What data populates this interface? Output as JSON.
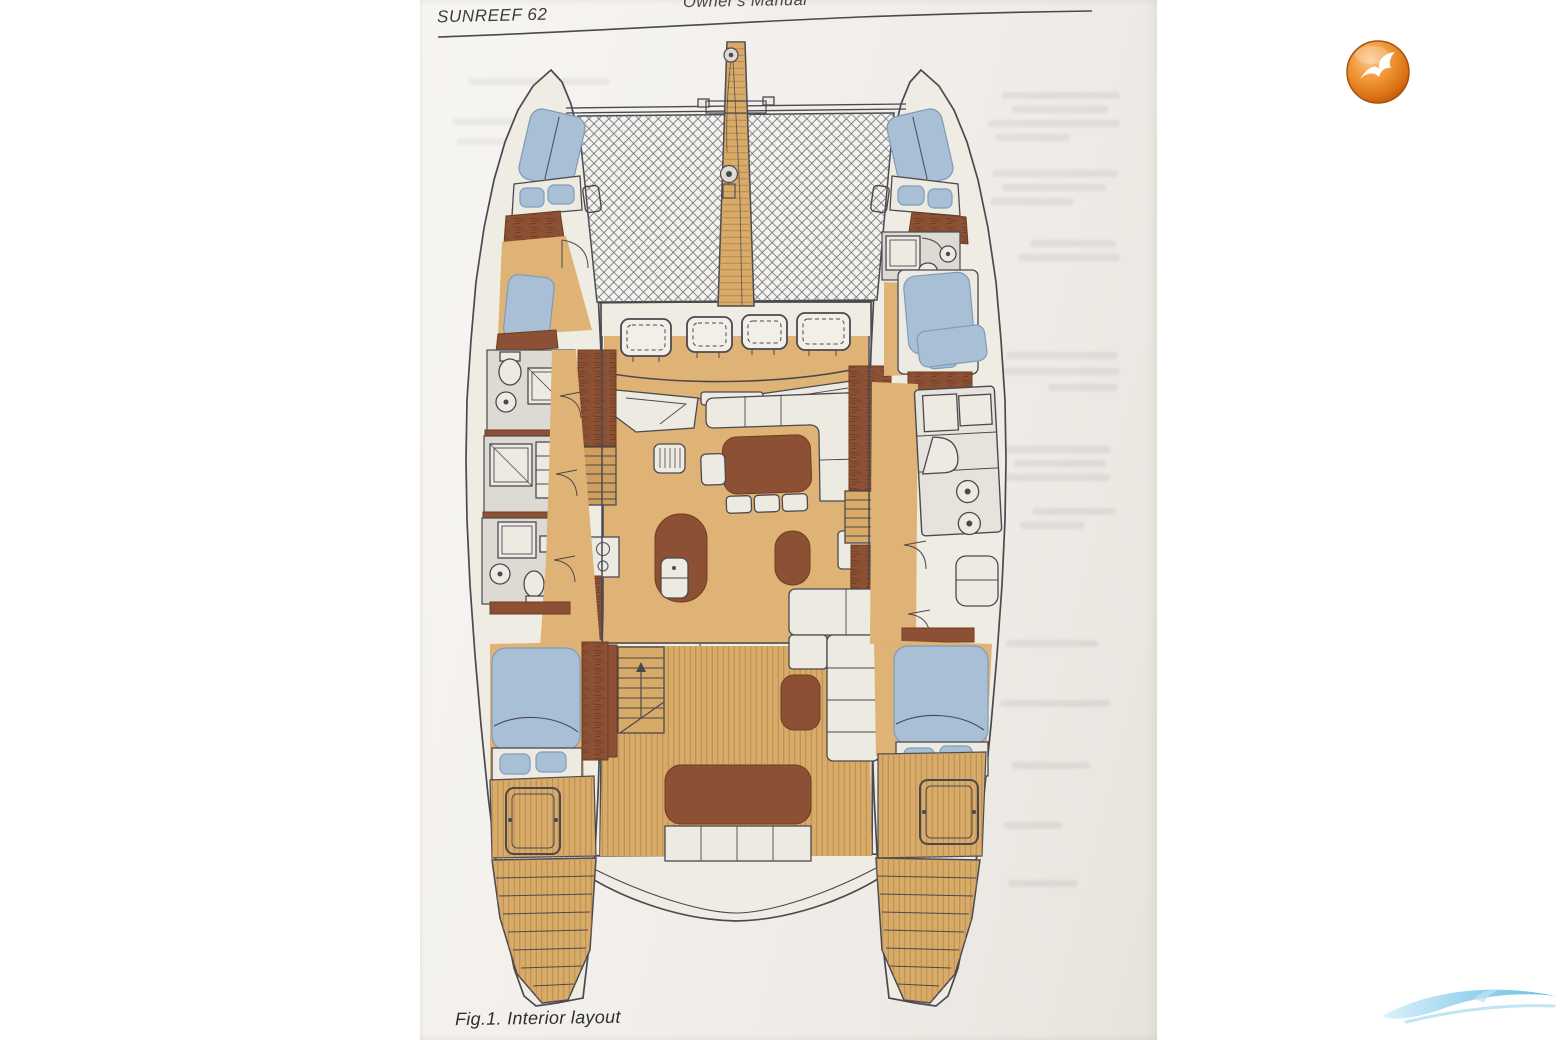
{
  "page": {
    "header_left": "SUNREEF 62",
    "header_center": "Owner's Manual",
    "figure_caption": "Fig.1. Interior layout"
  },
  "branding": {
    "corner_logo_icon": "orange-seagull-badge-icon",
    "watermark_icon": "blue-wave-swoosh-icon"
  },
  "figure": {
    "type": "catamaran-interior-floor-plan",
    "features": [
      "bowsprit-walkway",
      "anchor-windlass",
      "bow-trampoline-net",
      "v-berths",
      "bow-pillow-shelves",
      "foredeck-hatches",
      "coachroof-hatch-row",
      "helm-seats",
      "saloon-sofa",
      "saloon-dining-table-and-stools",
      "galley-island-with-sink",
      "stove-cooktop",
      "port-bathrooms",
      "starboard-forward-bathroom",
      "starboard-galley-counter-with-round-sinks",
      "hull-double-berths",
      "companionway-stairs",
      "cockpit-teak-floor",
      "cockpit-table-and-benches",
      "aft-side-deck-hatches",
      "transom-steps",
      "aft-platform-curve"
    ]
  },
  "colors": {
    "paper": "#f2efeb",
    "ink_outline": "#4b4950",
    "wood_floor": "#dfb275",
    "teak_deck": "#d8ab69",
    "furniture_brown": "#8c5134",
    "cushion_blue": "#a8bfd5",
    "deck_white": "#efece4",
    "fixture_gray": "#dcdad3",
    "logo_orange": "#e07f1e",
    "wave_blue": "#6cc0e4"
  }
}
